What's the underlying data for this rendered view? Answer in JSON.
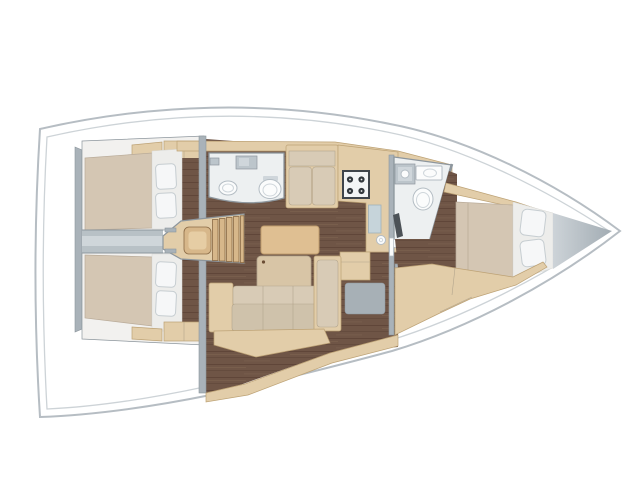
{
  "figure": {
    "kind": "Sailing yacht interior floor plan (top-down render), bow to the right, stern to the left",
    "visible_text": "none"
  },
  "areas": [
    {
      "id": "aft-cabin-port",
      "label": "aft double cabin (top)"
    },
    {
      "id": "aft-cabin-starboard",
      "label": "aft double cabin (bottom)"
    },
    {
      "id": "companionway",
      "label": "companionway steps / engine box"
    },
    {
      "id": "aft-head",
      "label": "aft head with sink and toilet"
    },
    {
      "id": "saloon",
      "label": "saloon with table, chair and L-sofa"
    },
    {
      "id": "galley",
      "label": "galley with stove and sink"
    },
    {
      "id": "forward-head",
      "label": "forward head with sink and toilet"
    },
    {
      "id": "forward-cabin",
      "label": "forward double cabin"
    },
    {
      "id": "bow-locker",
      "label": "bow / anchor locker"
    }
  ],
  "colors": {
    "page_bg": "#ffffff",
    "hull_fill": "#ffffff",
    "hull_stroke": "#b6bdc3",
    "deck_line": "#cdd3d7",
    "wood": "#e2cda9",
    "wood_light": "#ecdcbd",
    "wood_edge": "#bda275",
    "step_wood": "#d7b78a",
    "step_wood_light": "#e6cda4",
    "step_edge": "#8a6a45",
    "plank_base": "#6f5546",
    "plank_dark": "#543b2e",
    "plank_light": "#826753",
    "mattress": "#d4c6b3",
    "mattress_edge": "#b9ab99",
    "cushion": "#cfc2ab",
    "cushion_back": "#d8cbb6",
    "cushion_edge": "#b3a58d",
    "pillow": "#f6f7f8",
    "pillow_stroke": "#c6cdd1",
    "pillow_band": "#ededeb",
    "pillow_band_edge": "#d9d9d5",
    "cabin_bg": "#f2f1ef",
    "wall": "#a9b2b9",
    "wall_edge": "#8d969d",
    "corridor": "#b8c1c6",
    "corridor_light": "#cfd6da",
    "bath_floor": "#edf0f1",
    "fixture": "#fbfcfc",
    "fixture_stroke": "#b4bdc4",
    "fixture_inner": "#cfd6db",
    "cabinet_gray": "#bcc5cb",
    "sink_panel": "#c6d4da",
    "sink_panel_edge": "#9fb1b9",
    "stove_face": "#f3f4f5",
    "stove_frame": "#3f444a",
    "burner": "#33383d",
    "nav_gray": "#a7b0b6",
    "table": "#dfbf92",
    "table_edge": "#c09e6e",
    "chair": "#d8c5a6",
    "chair_dot": "#6b4e35",
    "dark_item": "#4c5257",
    "bow_shade_light": "#cdd3d8",
    "bow_shade_dark": "#a2acb3"
  }
}
